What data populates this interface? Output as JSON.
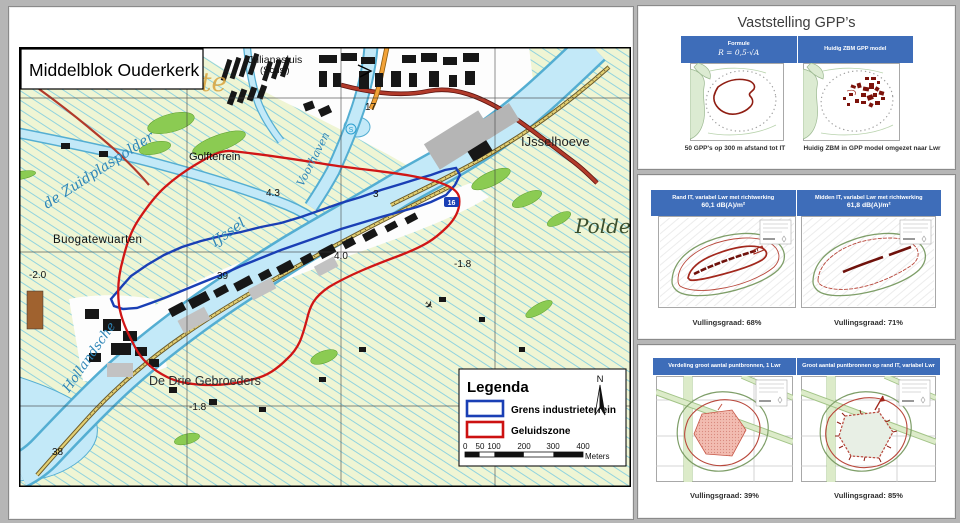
{
  "map": {
    "title": "Middelblok Ouderkerk",
    "labels": {
      "watermark": "te",
      "julianasluis": "Julianasluis",
      "julianasluis2": "(Schsl)",
      "zuidplaspolder": "de Zuidplaspolder",
      "golfterrein": "Golfterrein",
      "ijsselhoeve": "IJsselhoeve",
      "polder": "Polder",
      "buurt": "Buogatewuarten",
      "drie_gebroeders": "De Drie Gebroeders",
      "hollandsche": "Hollandsche",
      "ijssel": "IJssel",
      "voorhaven": "Voorhaven",
      "s_symbol": "S",
      "plane_symbol": "✈"
    },
    "spot_heights": {
      "k17": "17",
      "k43": "4.3",
      "k3": "3",
      "k40": "4.0",
      "k39": "39",
      "k38": "38",
      "km20": "-2.0",
      "km18a": "-1.8",
      "km18b": "-1.8",
      "k16": "16"
    },
    "legend": {
      "title": "Legenda",
      "item1": "Grens industrieterrein",
      "item2": "Geluidszone",
      "ticks": [
        "0",
        "50",
        "100",
        "200",
        "300",
        "400"
      ],
      "unit": "Meters",
      "north": "N"
    }
  },
  "slides": [
    {
      "title": "Vaststelling GPP’s",
      "header_left_title": "Formule",
      "header_left_formula": "R = 0,5·√A",
      "header_right_title": "Huidig ZBM GPP model",
      "caption_left": "50 GPP's op 300 m afstand tot IT",
      "caption_right": "Huidig ZBM in GPP model omgezet naar Lwr"
    },
    {
      "header_left_title": "Rand IT, variabel Lwr met richtwerking",
      "header_left_sub": "60,1 dB(A)/m²",
      "header_right_title": "Midden IT, variabel Lwr met richtwerking",
      "header_right_sub": "61,8 dB(A)/m²",
      "caption_left": "Vullingsgraad: 68%",
      "caption_right": "Vullingsgraad: 71%"
    },
    {
      "header_left_title": "Verdeling groot aantal puntbronnen, 1 Lwr",
      "header_right_title": "Groot aantal puntbronnen op rand IT, variabel Lwr",
      "caption_left": "Vullingsgraad: 39%",
      "caption_right": "Vullingsgraad: 85%"
    }
  ],
  "colors": {
    "band_blue": "#3e6db9",
    "boundary_blue": "#1a3fb5",
    "zone_red": "#cc1111"
  }
}
